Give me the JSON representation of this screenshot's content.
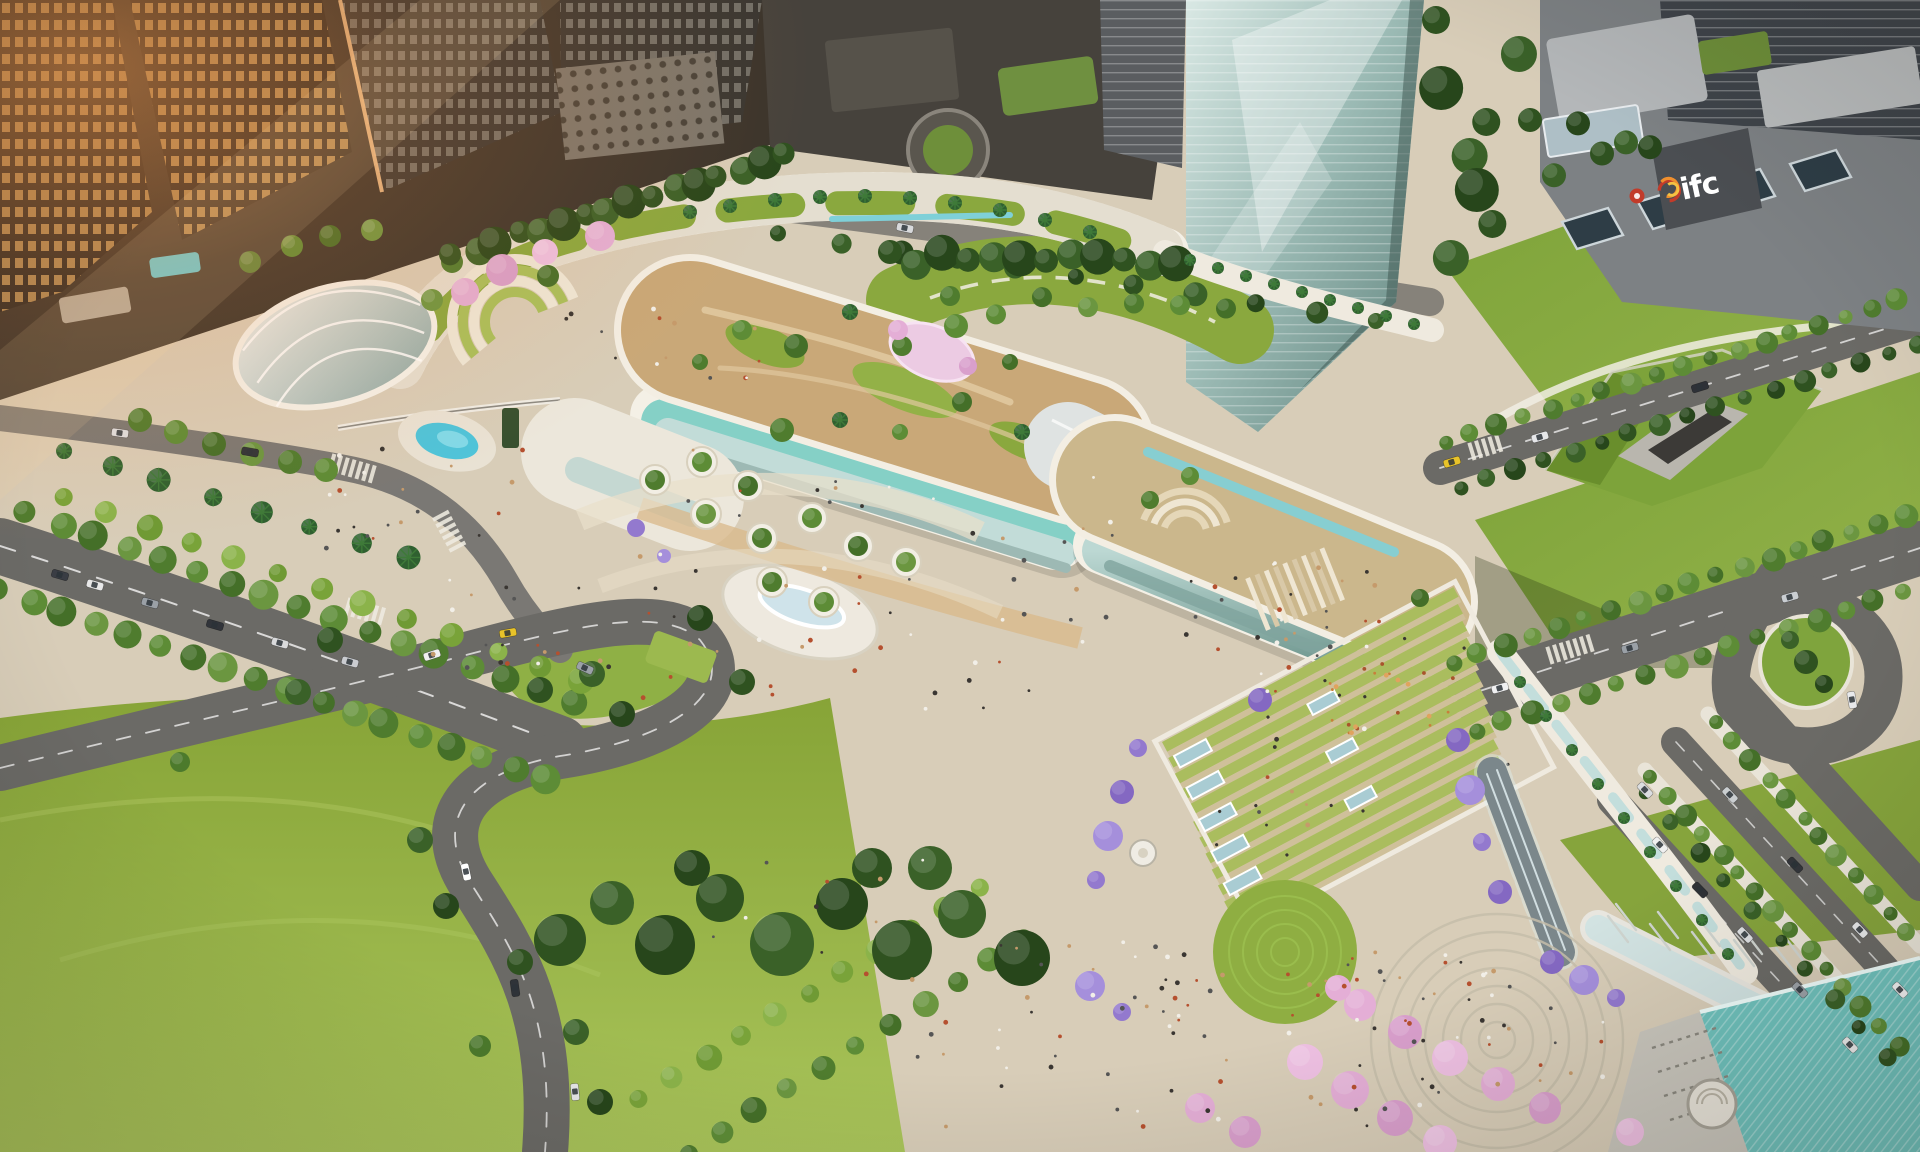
{
  "visible_text": {
    "ifc_logo": "ifc"
  },
  "scene": {
    "description": "Aerial architectural rendering of a mixed-use mall podium with rooftop gardens, plazas, lawns, boulevards and skyscrapers",
    "landmarks": [
      "office-towers",
      "glass-supertall-tower",
      "ifc-building",
      "skybridge",
      "mall-podium-rooftop-garden",
      "garden-ribbon-walkway",
      "oval-glass-pavilion",
      "swimming-pool",
      "terraced-amphitheater",
      "circular-lawn",
      "concentric-circle-plaza",
      "cherry-blossom-trees",
      "tree-lined-boulevards",
      "grass-tunnel-portal",
      "teal-roof-pavilion"
    ]
  },
  "palette": {
    "plaza": "#d8cdb8",
    "plazaLight": "#e7ddc9",
    "path": "#f1ede3",
    "lawn": "#8aa83e",
    "lawnBright": "#a6c155",
    "lawnDark": "#6e8c31",
    "towerDark": "#2f2a24",
    "towerMid": "#4a463f",
    "winWarm": "#c59a5e",
    "winCool": "#8f8d86",
    "glassTowerHi": "#d9e8e4",
    "glassTowerLo": "#5f827c",
    "ifcGrey": "#7d8184",
    "ifcWall": "#4b4e52",
    "logoRed": "#c23b2a",
    "logoOrange": "#ef8f2e",
    "logoYellow": "#f4c243",
    "mallWhite": "#f0ebdf",
    "aqua": "#85d0c6",
    "glassPale": "#c2dcd8",
    "terrace": "#c9a878",
    "road": "#6b6a66",
    "roadDark": "#59585b",
    "pool": "#4ec4da",
    "tealRoof": "#6fc2bd",
    "skylight": "#a9ccd3",
    "pink": "#e4aed6",
    "pinkLight": "#f2cfe8",
    "purple": "#9379ce",
    "peopleDark": "#3a3632",
    "peopleWhite": "#f2efe8",
    "peopleRed": "#b5502f",
    "peopleTan": "#c59a6b",
    "flare": "#f08a3c"
  }
}
